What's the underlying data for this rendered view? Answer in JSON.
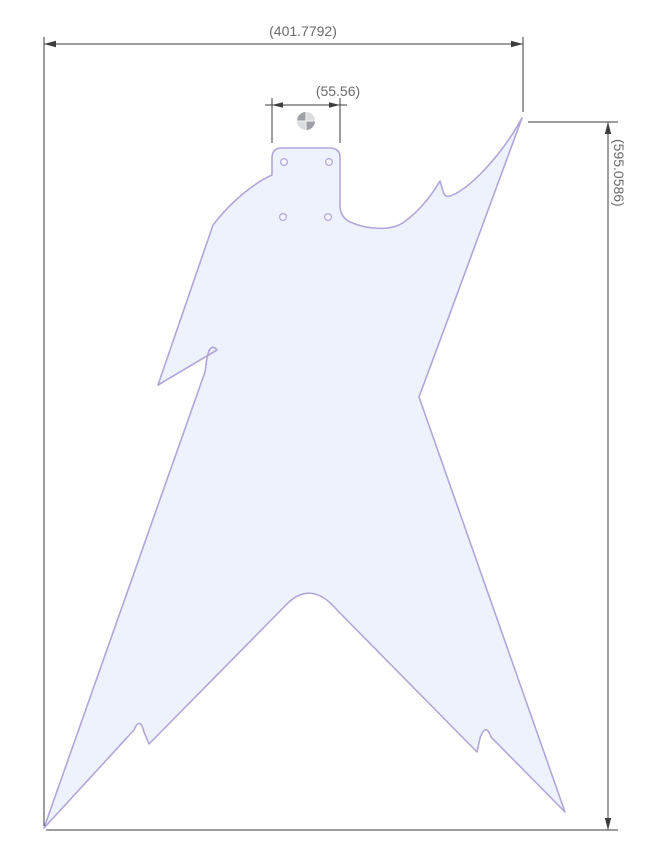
{
  "drawing": {
    "body_path": "M 272 158 Q 272 148 282 148 L 330 148 Q 340 148 340 158 L 340 205 Q 340 217 350 222 C 368 230 392 231 404 222 C 418 212 430 198 440 181 L 443 191 Q 445 198 450 196 C 468 190 500 158 522 118 C 496 190 455 300 419 397 L 565 812 L 491 737 Q 486 722 480 738 L 477 752 L 337 610 Q 310 578 284 607 L 149 744 L 144 732 Q 140 716 134 730 L 44 828 L 205 372 L 207 358 Q 210 342 217 350 L 158 385 L 213 225 C 230 203 252 184 272 175 Z",
    "holes_path": "M 287.4 162 a 3.4 3.4 0 1 0 -6.8 0 a 3.4 3.4 0 1 0 6.8 0 M 332.4 162 a 3.4 3.4 0 1 0 -6.8 0 a 3.4 3.4 0 1 0 6.8 0 M 286.4 217 a 3.4 3.4 0 1 0 -6.8 0 a 3.4 3.4 0 1 0 6.8 0 M 331.4 217 a 3.4 3.4 0 1 0 -6.8 0 a 3.4 3.4 0 1 0 6.8 0",
    "dimensions": {
      "overall_width": "(401.7792)",
      "neck_pocket_width": "(55.56)",
      "overall_height": "(595.0586)"
    },
    "colors": {
      "body_fill": "#edf2fc",
      "body_outline": "#b2a6d9",
      "dimension_lines": "#3d3d3d",
      "dimension_text": "#6a6a6a",
      "background": "#ffffff"
    }
  }
}
